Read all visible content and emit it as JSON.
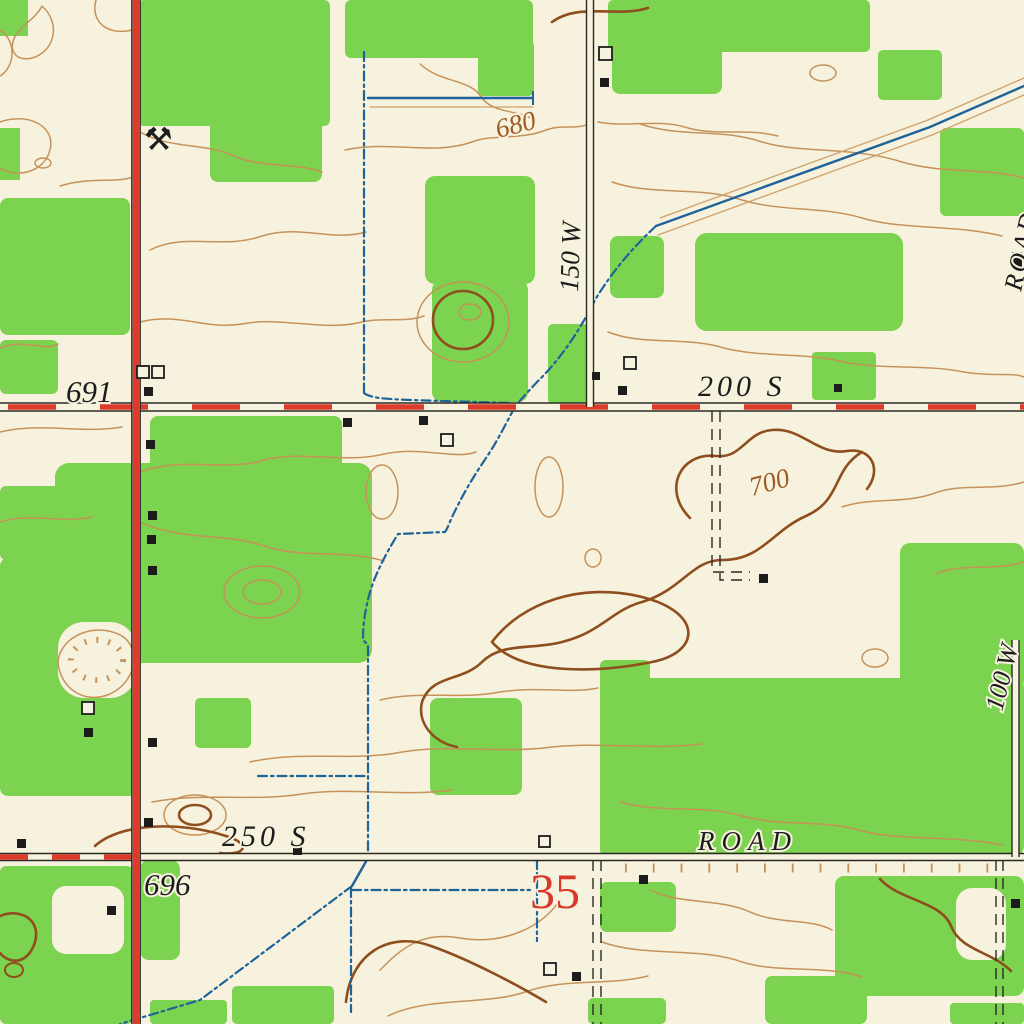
{
  "map": {
    "kind": "topographic-map",
    "labels": {
      "spot_elevation_691": "691",
      "spot_elevation_696": "696",
      "contour_680": "680",
      "contour_700": "700",
      "road_150w": "150 W",
      "road_200s": "200 S",
      "road_250s": "250 S",
      "road_label_bottom": "ROAD",
      "road_label_right_edge": "ROAD",
      "road_100w": "100 W",
      "section_number": "35",
      "mine_symbol": "⚒"
    },
    "colors": {
      "background_cream": "#F6F2DD",
      "woodland_green": "#7CD34F",
      "contour_brown": "#C6925A",
      "index_contour_brown": "#8F4E1D",
      "road_red": "#DD3B2C",
      "water_blue": "#1F639B",
      "feature_black": "#1C1C1C",
      "section_number_red": "#D8372B"
    }
  }
}
